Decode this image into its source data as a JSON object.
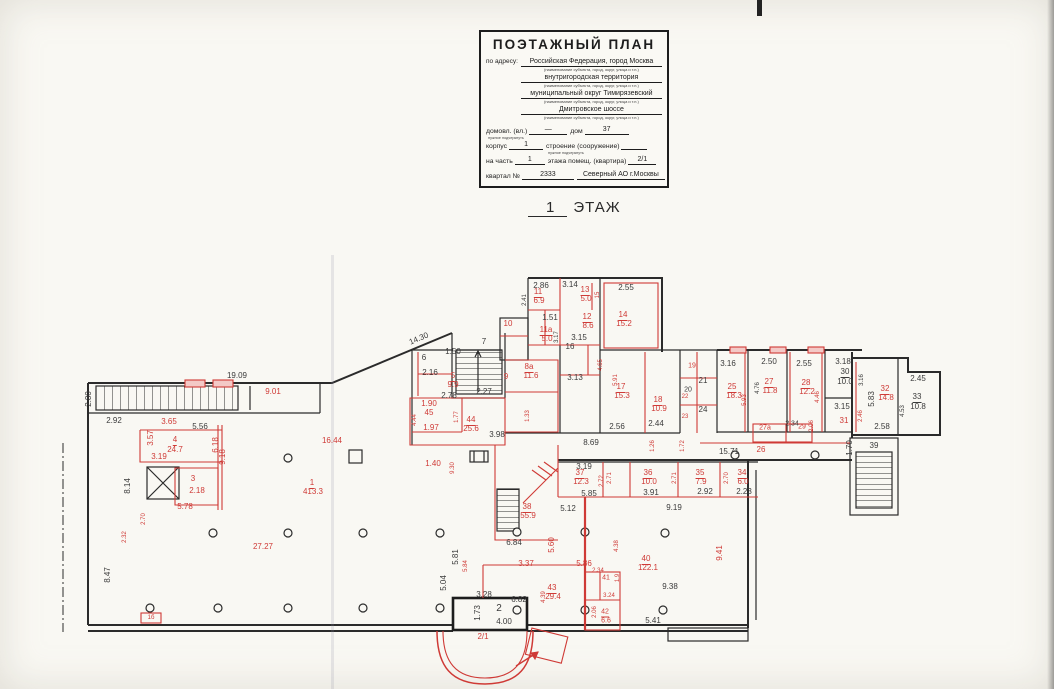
{
  "title_block": {
    "title": "ПОЭТАЖНЫЙ ПЛАН",
    "address_label": "по адресу:",
    "name_caption": "(наименование субъекта, город, округ, улица и т.п.)",
    "address_lines": [
      "Российская Федерация, город Москва",
      "внутригородская территория",
      "муниципальный округ Тимирязевский",
      "Дмитровское шоссе"
    ],
    "fields": [
      [
        {
          "t": "домовл. (вл.)",
          "cap": "нужное подчеркнуть"
        },
        {
          "v": "—",
          "w": 38
        },
        {
          "t": "дом"
        },
        {
          "v": "37",
          "w": 44
        }
      ],
      [
        {
          "t": "корпус"
        },
        {
          "v": "1",
          "w": 34
        },
        {
          "t": "строение (сооружение)",
          "cap": "нужное подчеркнуть"
        },
        {
          "v": "",
          "w": 26
        }
      ],
      [
        {
          "t": "на часть"
        },
        {
          "v": "1",
          "w": 30
        },
        {
          "t": "этажа помещ. (квартира)"
        },
        {
          "v": "2/1",
          "w": 28
        }
      ],
      [
        {
          "t": "квартал №"
        },
        {
          "v": "2333",
          "w": 52
        },
        {
          "v": "Северный АО г.Москвы",
          "w": 88
        }
      ]
    ]
  },
  "floor_label": {
    "number": "1",
    "text": "ЭТАЖ"
  },
  "colors": {
    "wall": "#2b2b2b",
    "red": "#cf3a36",
    "paper": "#f9f8f3"
  },
  "plan": {
    "labels": [
      {
        "t": "19.09",
        "x": 237,
        "y": 376,
        "c": "k"
      },
      {
        "t": "9.01",
        "x": 273,
        "y": 392,
        "c": "r"
      },
      {
        "t": "2.80",
        "x": 89,
        "y": 399,
        "c": "k",
        "rot": -90
      },
      {
        "t": "2.92",
        "x": 114,
        "y": 421,
        "c": "k"
      },
      {
        "t": "3.65",
        "x": 169,
        "y": 422,
        "c": "r"
      },
      {
        "t": "5.56",
        "x": 200,
        "y": 427,
        "c": "k"
      },
      {
        "t": "3.57",
        "x": 151,
        "y": 438,
        "c": "r",
        "rot": -90
      },
      {
        "t": "4",
        "x": 175,
        "y": 441,
        "c": "r",
        "u": 1
      },
      {
        "t": "24.7",
        "x": 175,
        "y": 450,
        "c": "r"
      },
      {
        "t": "3.19",
        "x": 159,
        "y": 457,
        "c": "r"
      },
      {
        "t": "6.18",
        "x": 216,
        "y": 445,
        "c": "r",
        "rot": -90
      },
      {
        "t": "9.18",
        "x": 223,
        "y": 457,
        "c": "r",
        "rot": -90
      },
      {
        "t": "8.14",
        "x": 128,
        "y": 486,
        "c": "k",
        "rot": -90
      },
      {
        "t": "3",
        "x": 193,
        "y": 479,
        "c": "r"
      },
      {
        "t": "2.18",
        "x": 197,
        "y": 491,
        "c": "r"
      },
      {
        "t": "5.78",
        "x": 185,
        "y": 507,
        "c": "r"
      },
      {
        "t": "2.32",
        "x": 125,
        "y": 537,
        "c": "r",
        "rot": -90,
        "fs": 6
      },
      {
        "t": "2.70",
        "x": 144,
        "y": 519,
        "c": "r",
        "rot": -90,
        "fs": 6
      },
      {
        "t": "8.47",
        "x": 108,
        "y": 575,
        "c": "k",
        "rot": -90
      },
      {
        "t": "1б",
        "x": 151,
        "y": 618,
        "c": "r",
        "fs": 6
      },
      {
        "t": "16.44",
        "x": 332,
        "y": 441,
        "c": "r"
      },
      {
        "t": "1",
        "x": 312,
        "y": 484,
        "c": "r",
        "u": 1
      },
      {
        "t": "413.3",
        "x": 313,
        "y": 492,
        "c": "r"
      },
      {
        "t": "27.27",
        "x": 263,
        "y": 547,
        "c": "r"
      },
      {
        "t": "14.30",
        "x": 419,
        "y": 339,
        "c": "k",
        "rot": -23
      },
      {
        "t": "6",
        "x": 424,
        "y": 358,
        "c": "k"
      },
      {
        "t": "2.16",
        "x": 430,
        "y": 373,
        "c": "k"
      },
      {
        "t": "1.50",
        "x": 453,
        "y": 352,
        "c": "k"
      },
      {
        "t": "7",
        "x": 484,
        "y": 342,
        "c": "k"
      },
      {
        "t": "2.78",
        "x": 449,
        "y": 396,
        "c": "k"
      },
      {
        "t": "2.27",
        "x": 484,
        "y": 392,
        "c": "k"
      },
      {
        "t": "5",
        "x": 453,
        "y": 377,
        "c": "r",
        "u": 1
      },
      {
        "t": "9.9",
        "x": 453,
        "y": 385,
        "c": "r"
      },
      {
        "t": "10",
        "x": 508,
        "y": 324,
        "c": "r"
      },
      {
        "t": "9",
        "x": 506,
        "y": 377,
        "c": "r"
      },
      {
        "t": "8а",
        "x": 529,
        "y": 368,
        "c": "r",
        "u": 1
      },
      {
        "t": "11.6",
        "x": 531,
        "y": 376,
        "c": "r"
      },
      {
        "t": "1.90",
        "x": 429,
        "y": 404,
        "c": "r"
      },
      {
        "t": "45",
        "x": 429,
        "y": 413,
        "c": "r"
      },
      {
        "t": "1.97",
        "x": 431,
        "y": 428,
        "c": "r"
      },
      {
        "t": "1.77",
        "x": 457,
        "y": 417,
        "c": "r",
        "rot": -90,
        "fs": 6
      },
      {
        "t": "4.44",
        "x": 415,
        "y": 420,
        "c": "r",
        "rot": -90,
        "fs": 6
      },
      {
        "t": "44",
        "x": 471,
        "y": 421,
        "c": "r",
        "u": 1
      },
      {
        "t": "25.6",
        "x": 471,
        "y": 429,
        "c": "r"
      },
      {
        "t": "3.98",
        "x": 497,
        "y": 435,
        "c": "k"
      },
      {
        "t": "1.40",
        "x": 433,
        "y": 464,
        "c": "r"
      },
      {
        "t": "1.33",
        "x": 528,
        "y": 416,
        "c": "r",
        "rot": -90,
        "fs": 6
      },
      {
        "t": "9.30",
        "x": 453,
        "y": 468,
        "c": "r",
        "rot": -90,
        "fs": 6
      },
      {
        "t": "2.86",
        "x": 541,
        "y": 286,
        "c": "k"
      },
      {
        "t": "3.14",
        "x": 570,
        "y": 285,
        "c": "k"
      },
      {
        "t": "2.55",
        "x": 626,
        "y": 288,
        "c": "k"
      },
      {
        "t": "2.41",
        "x": 525,
        "y": 300,
        "c": "k",
        "rot": -90,
        "fs": 6
      },
      {
        "t": "11",
        "x": 538,
        "y": 293,
        "c": "r",
        "u": 1
      },
      {
        "t": "6.9",
        "x": 539,
        "y": 301,
        "c": "r"
      },
      {
        "t": "13",
        "x": 585,
        "y": 291,
        "c": "r",
        "u": 1
      },
      {
        "t": "5.0",
        "x": 586,
        "y": 299,
        "c": "r"
      },
      {
        "t": "15",
        "x": 598,
        "y": 295,
        "c": "r",
        "rot": -90,
        "fs": 6
      },
      {
        "t": "1.51",
        "x": 550,
        "y": 318,
        "c": "k"
      },
      {
        "t": "12",
        "x": 587,
        "y": 318,
        "c": "r",
        "u": 1
      },
      {
        "t": "8.6",
        "x": 588,
        "y": 326,
        "c": "r"
      },
      {
        "t": "14",
        "x": 623,
        "y": 316,
        "c": "r",
        "u": 1
      },
      {
        "t": "15.2",
        "x": 624,
        "y": 324,
        "c": "r"
      },
      {
        "t": "11а",
        "x": 546,
        "y": 331,
        "c": "r",
        "u": 1
      },
      {
        "t": "5.0",
        "x": 547,
        "y": 339,
        "c": "r"
      },
      {
        "t": "3.17",
        "x": 557,
        "y": 337,
        "c": "k",
        "rot": -90,
        "fs": 6
      },
      {
        "t": "3.15",
        "x": 579,
        "y": 338,
        "c": "k"
      },
      {
        "t": "16",
        "x": 570,
        "y": 347,
        "c": "k"
      },
      {
        "t": "3.13",
        "x": 575,
        "y": 378,
        "c": "k"
      },
      {
        "t": "5.91",
        "x": 616,
        "y": 380,
        "c": "r",
        "rot": -90,
        "fs": 6
      },
      {
        "t": "4.65",
        "x": 601,
        "y": 365,
        "c": "r",
        "rot": -90,
        "fs": 6
      },
      {
        "t": "17",
        "x": 621,
        "y": 388,
        "c": "r",
        "u": 1
      },
      {
        "t": "15.3",
        "x": 622,
        "y": 396,
        "c": "r"
      },
      {
        "t": "18",
        "x": 658,
        "y": 401,
        "c": "r",
        "u": 1
      },
      {
        "t": "10.9",
        "x": 659,
        "y": 409,
        "c": "r"
      },
      {
        "t": "2.44",
        "x": 656,
        "y": 424,
        "c": "k"
      },
      {
        "t": "2.56",
        "x": 617,
        "y": 427,
        "c": "k"
      },
      {
        "t": "19",
        "x": 692,
        "y": 366,
        "c": "r",
        "fs": 7
      },
      {
        "t": "20",
        "x": 688,
        "y": 390,
        "c": "k",
        "fs": 7
      },
      {
        "t": "21",
        "x": 703,
        "y": 381,
        "c": "k"
      },
      {
        "t": "22",
        "x": 685,
        "y": 397,
        "c": "r",
        "fs": 6
      },
      {
        "t": "23",
        "x": 685,
        "y": 417,
        "c": "r",
        "fs": 6
      },
      {
        "t": "24",
        "x": 703,
        "y": 410,
        "c": "k"
      },
      {
        "t": "3.16",
        "x": 728,
        "y": 364,
        "c": "k"
      },
      {
        "t": "25",
        "x": 732,
        "y": 388,
        "c": "r",
        "u": 1
      },
      {
        "t": "18.3",
        "x": 734,
        "y": 396,
        "c": "r"
      },
      {
        "t": "5.93",
        "x": 745,
        "y": 400,
        "c": "r",
        "rot": -90,
        "fs": 6
      },
      {
        "t": "2.50",
        "x": 769,
        "y": 362,
        "c": "k"
      },
      {
        "t": "4.76",
        "x": 758,
        "y": 388,
        "c": "k",
        "rot": -90,
        "fs": 6
      },
      {
        "t": "27",
        "x": 769,
        "y": 383,
        "c": "r",
        "u": 1
      },
      {
        "t": "11.8",
        "x": 770,
        "y": 391,
        "c": "r"
      },
      {
        "t": "2.55",
        "x": 804,
        "y": 364,
        "c": "k"
      },
      {
        "t": "28",
        "x": 806,
        "y": 384,
        "c": "r",
        "u": 1
      },
      {
        "t": "12.2",
        "x": 807,
        "y": 392,
        "c": "r"
      },
      {
        "t": "4.46",
        "x": 818,
        "y": 397,
        "c": "r",
        "rot": -90,
        "fs": 6
      },
      {
        "t": "3.18",
        "x": 843,
        "y": 362,
        "c": "k"
      },
      {
        "t": "30",
        "x": 845,
        "y": 373,
        "c": "k",
        "u": 1
      },
      {
        "t": "10.0",
        "x": 845,
        "y": 382,
        "c": "k"
      },
      {
        "t": "3.16",
        "x": 862,
        "y": 380,
        "c": "k",
        "rot": -90,
        "fs": 6
      },
      {
        "t": "3.15",
        "x": 842,
        "y": 407,
        "c": "k"
      },
      {
        "t": "31",
        "x": 844,
        "y": 421,
        "c": "r"
      },
      {
        "t": "2.46",
        "x": 861,
        "y": 416,
        "c": "r",
        "rot": -90,
        "fs": 6
      },
      {
        "t": "27а",
        "x": 765,
        "y": 428,
        "c": "r",
        "fs": 7
      },
      {
        "t": "2.34",
        "x": 792,
        "y": 424,
        "c": "k",
        "fs": 7
      },
      {
        "t": "29",
        "x": 802,
        "y": 427,
        "c": "r",
        "fs": 7
      },
      {
        "t": "2.06",
        "x": 812,
        "y": 426,
        "c": "r",
        "rot": -90,
        "fs": 6
      },
      {
        "t": "26",
        "x": 761,
        "y": 450,
        "c": "r"
      },
      {
        "t": "15.71",
        "x": 729,
        "y": 452,
        "c": "k"
      },
      {
        "t": "1.70",
        "x": 850,
        "y": 448,
        "c": "k",
        "rot": -90
      },
      {
        "t": "2.45",
        "x": 918,
        "y": 379,
        "c": "k"
      },
      {
        "t": "5.83",
        "x": 872,
        "y": 399,
        "c": "k",
        "rot": -90
      },
      {
        "t": "32",
        "x": 885,
        "y": 390,
        "c": "r",
        "u": 1
      },
      {
        "t": "14.8",
        "x": 886,
        "y": 398,
        "c": "r"
      },
      {
        "t": "33",
        "x": 917,
        "y": 398,
        "c": "k",
        "u": 1
      },
      {
        "t": "10.8",
        "x": 918,
        "y": 407,
        "c": "k"
      },
      {
        "t": "4.53",
        "x": 903,
        "y": 411,
        "c": "k",
        "rot": -90,
        "fs": 6
      },
      {
        "t": "2.58",
        "x": 882,
        "y": 427,
        "c": "k"
      },
      {
        "t": "39",
        "x": 874,
        "y": 446,
        "c": "k"
      },
      {
        "t": "8.69",
        "x": 591,
        "y": 443,
        "c": "k"
      },
      {
        "t": "1.26",
        "x": 653,
        "y": 446,
        "c": "r",
        "rot": -90,
        "fs": 6
      },
      {
        "t": "1.72",
        "x": 683,
        "y": 446,
        "c": "r",
        "rot": -90,
        "fs": 6
      },
      {
        "t": "3.19",
        "x": 584,
        "y": 467,
        "c": "k"
      },
      {
        "t": "37",
        "x": 580,
        "y": 474,
        "c": "r",
        "u": 1
      },
      {
        "t": "12.3",
        "x": 581,
        "y": 482,
        "c": "r"
      },
      {
        "t": "2.72",
        "x": 602,
        "y": 481,
        "c": "r",
        "rot": -90,
        "fs": 6
      },
      {
        "t": "2.71",
        "x": 610,
        "y": 478,
        "c": "r",
        "rot": -90,
        "fs": 6
      },
      {
        "t": "36",
        "x": 648,
        "y": 474,
        "c": "r",
        "u": 1
      },
      {
        "t": "10.0",
        "x": 649,
        "y": 482,
        "c": "r"
      },
      {
        "t": "2.71",
        "x": 675,
        "y": 478,
        "c": "r",
        "rot": -90,
        "fs": 6
      },
      {
        "t": "35",
        "x": 700,
        "y": 474,
        "c": "r",
        "u": 1
      },
      {
        "t": "7.9",
        "x": 701,
        "y": 482,
        "c": "r"
      },
      {
        "t": "2.70",
        "x": 727,
        "y": 478,
        "c": "r",
        "rot": -90,
        "fs": 6
      },
      {
        "t": "34",
        "x": 742,
        "y": 474,
        "c": "r",
        "u": 1
      },
      {
        "t": "6.0",
        "x": 743,
        "y": 482,
        "c": "r"
      },
      {
        "t": "5.85",
        "x": 589,
        "y": 494,
        "c": "k"
      },
      {
        "t": "3.91",
        "x": 651,
        "y": 493,
        "c": "k"
      },
      {
        "t": "2.92",
        "x": 705,
        "y": 492,
        "c": "k"
      },
      {
        "t": "2.23",
        "x": 744,
        "y": 492,
        "c": "k"
      },
      {
        "t": "5.12",
        "x": 568,
        "y": 509,
        "c": "k"
      },
      {
        "t": "9.19",
        "x": 674,
        "y": 508,
        "c": "k"
      },
      {
        "t": "38",
        "x": 527,
        "y": 508,
        "c": "r",
        "u": 1
      },
      {
        "t": "55.9",
        "x": 528,
        "y": 516,
        "c": "r"
      },
      {
        "t": "5.60",
        "x": 552,
        "y": 545,
        "c": "r",
        "rot": -90
      },
      {
        "t": "6.84",
        "x": 514,
        "y": 543,
        "c": "k"
      },
      {
        "t": "5.81",
        "x": 456,
        "y": 557,
        "c": "k",
        "rot": -90
      },
      {
        "t": "5.84",
        "x": 466,
        "y": 566,
        "c": "r",
        "rot": -90,
        "fs": 6
      },
      {
        "t": "5.04",
        "x": 444,
        "y": 583,
        "c": "k",
        "rot": -90
      },
      {
        "t": "3.37",
        "x": 526,
        "y": 564,
        "c": "r"
      },
      {
        "t": "5.86",
        "x": 584,
        "y": 564,
        "c": "r"
      },
      {
        "t": "2.34",
        "x": 598,
        "y": 571,
        "c": "r",
        "fs": 6
      },
      {
        "t": "41",
        "x": 606,
        "y": 578,
        "c": "r",
        "fs": 7
      },
      {
        "t": "1.9",
        "x": 618,
        "y": 578,
        "c": "r",
        "rot": -90,
        "fs": 6
      },
      {
        "t": "4.38",
        "x": 617,
        "y": 546,
        "c": "r",
        "rot": -90,
        "fs": 6
      },
      {
        "t": "40",
        "x": 646,
        "y": 560,
        "c": "r",
        "u": 1
      },
      {
        "t": "122.1",
        "x": 648,
        "y": 568,
        "c": "r"
      },
      {
        "t": "9.41",
        "x": 720,
        "y": 553,
        "c": "r",
        "rot": -90
      },
      {
        "t": "43",
        "x": 552,
        "y": 589,
        "c": "r",
        "u": 1
      },
      {
        "t": "29.4",
        "x": 553,
        "y": 597,
        "c": "r"
      },
      {
        "t": "4.39",
        "x": 544,
        "y": 597,
        "c": "r",
        "rot": -90,
        "fs": 6
      },
      {
        "t": "3.28",
        "x": 484,
        "y": 595,
        "c": "k"
      },
      {
        "t": "6.82",
        "x": 519,
        "y": 600,
        "c": "k"
      },
      {
        "t": "3.24",
        "x": 609,
        "y": 596,
        "c": "r",
        "fs": 6
      },
      {
        "t": "2.06",
        "x": 595,
        "y": 612,
        "c": "r",
        "rot": -90,
        "fs": 6
      },
      {
        "t": "42",
        "x": 605,
        "y": 613,
        "c": "r",
        "fs": 7,
        "u": 1
      },
      {
        "t": "6.6",
        "x": 606,
        "y": 621,
        "c": "r",
        "fs": 7
      },
      {
        "t": "9.38",
        "x": 670,
        "y": 587,
        "c": "k"
      },
      {
        "t": "5.41",
        "x": 653,
        "y": 621,
        "c": "k"
      },
      {
        "t": "1.73",
        "x": 478,
        "y": 613,
        "c": "k",
        "rot": -90
      },
      {
        "t": "2",
        "x": 499,
        "y": 609,
        "c": "k",
        "fs": 10
      },
      {
        "t": "4.00",
        "x": 504,
        "y": 622,
        "c": "k"
      },
      {
        "t": "2/1",
        "x": 483,
        "y": 637,
        "c": "r"
      }
    ]
  }
}
